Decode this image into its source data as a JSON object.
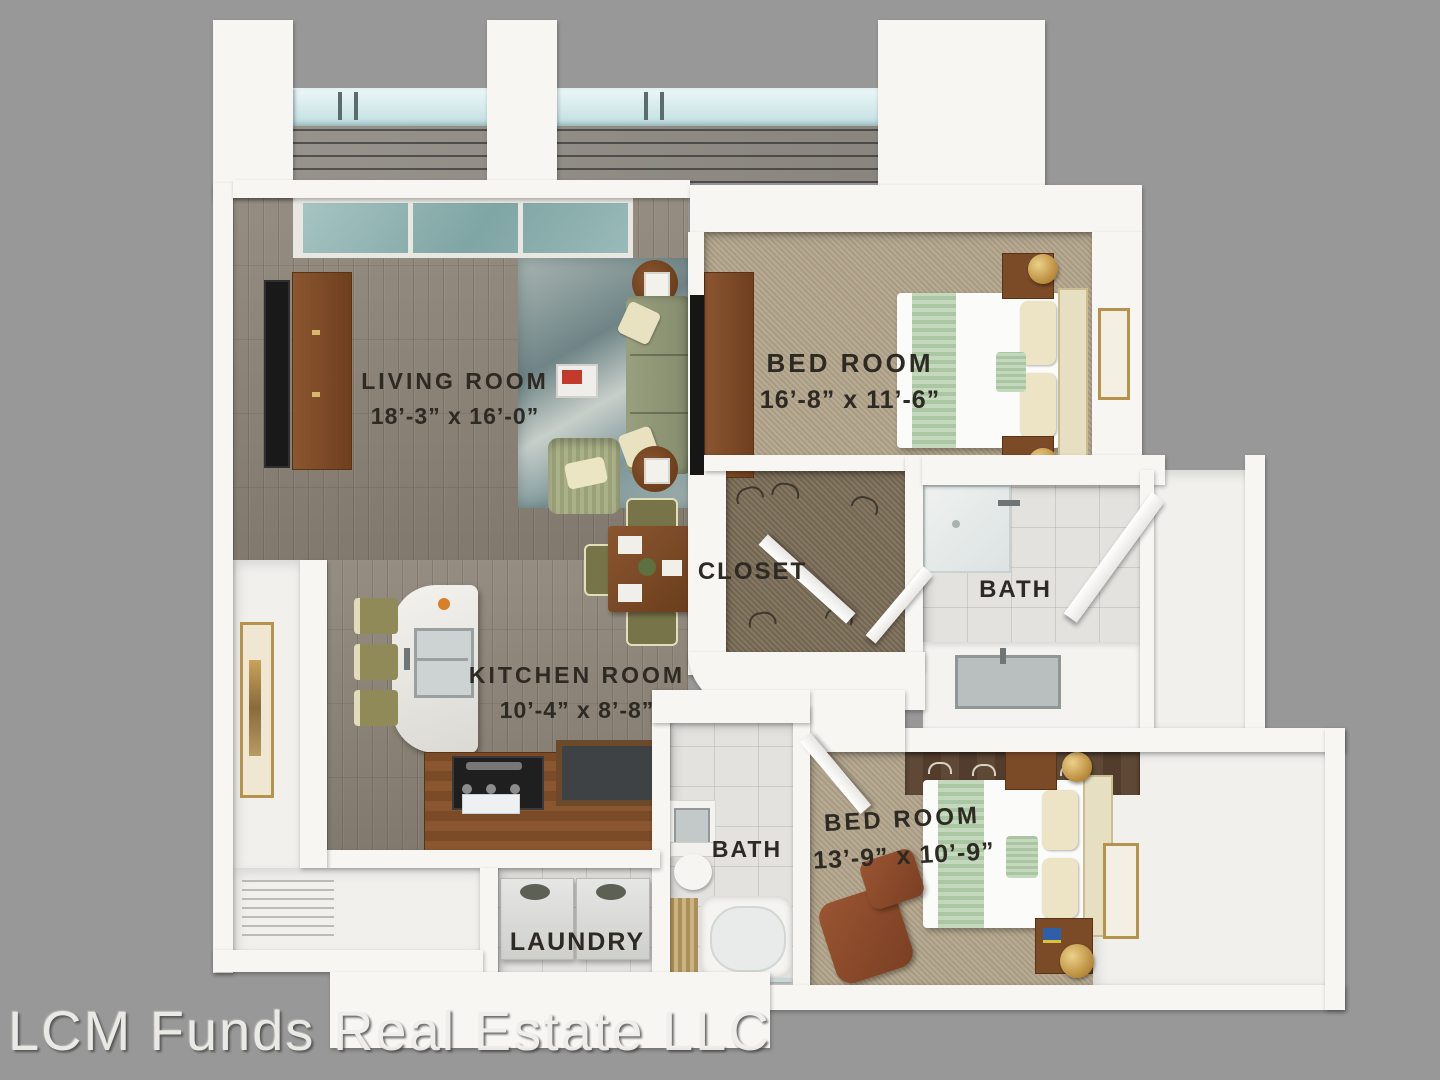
{
  "watermark": "LCM Funds Real Estate LLC",
  "rooms": {
    "living": {
      "name": "LIVING ROOM",
      "dims": "18’-3” x 16’-0”"
    },
    "bedroom1": {
      "name": "BED ROOM",
      "dims": "16’-8” x 11’-6”"
    },
    "closet": {
      "name": "CLOSET"
    },
    "bath1": {
      "name": "BATH"
    },
    "kitchen": {
      "name": "KITCHEN ROOM",
      "dims": "10’-4” x 8’-8”"
    },
    "bath2": {
      "name": "BATH"
    },
    "bedroom2": {
      "name": "BED ROOM",
      "dims": "13’-9” x 10’-9”"
    },
    "laundry": {
      "name": "LAUNDRY"
    }
  },
  "palette": {
    "background": "#989898",
    "wall": "#f7f6f3",
    "wood_floor": "#8b8378",
    "bedroom_carpet": "#b2a48b",
    "closet_carpet": "#7d6f59",
    "bath_tile": "#e3e2df",
    "area_rug": "#8fa3a3",
    "sofa_green": "#8f9678",
    "wood_furniture": "#7b4a27",
    "leather_chair": "#8a4a2e",
    "bedding_white": "#fbfbf9",
    "bed_runner_green": "#b7cfae",
    "lamp_gold": "#c9a24b",
    "balcony_glass": "#bedde0",
    "label_text": "#2d2923",
    "watermark_text": "#efeeeb"
  }
}
